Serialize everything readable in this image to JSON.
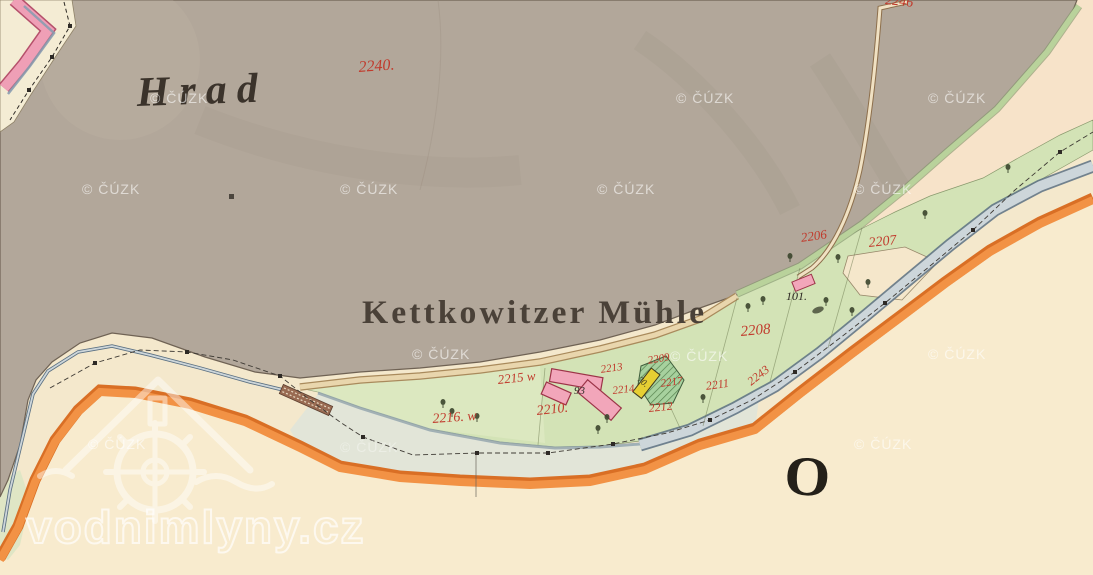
{
  "map": {
    "title": "Historic cadastral map sheet",
    "labels": {
      "hill_region": "Hrad",
      "mill": "Kettkowitzer Mühle",
      "sheet_letter": "O"
    },
    "parcel_numbers": {
      "p2240": "2240.",
      "p2246": "2246",
      "p2206": "2206",
      "p2207": "2207",
      "p2208": "2208",
      "p2209": "2209",
      "p2210": "2210.",
      "p2211": "2211",
      "p2212": "2212",
      "p2213": "2213",
      "p2214": "2214",
      "p2215": "2215 w",
      "p2216": "2216. w",
      "p2217": "2217",
      "p2243": "2243"
    },
    "building_numbers": {
      "b93": "93",
      "b70": "70.",
      "b101": "101."
    },
    "colors": {
      "hill_taupe": "#b2a79a",
      "paper_cream": "#f5e9cd",
      "band_pink_cream": "#f7e3c9",
      "meadow_green": "#d3e3b6",
      "river_fill": "#cdd6da",
      "river_edge": "#5b7082",
      "road_orange": "#f29245",
      "road_edge": "#d96f25",
      "building_masonry_pink": "#f2a6ba",
      "building_wood_yellow": "#e6cf33",
      "parcel_number_red": "#c13a2c"
    }
  },
  "watermark": {
    "text": "© ČÚZK"
  },
  "branding": {
    "site_watermark": "vodnimlyny.cz",
    "logo": "watermill-logo"
  }
}
